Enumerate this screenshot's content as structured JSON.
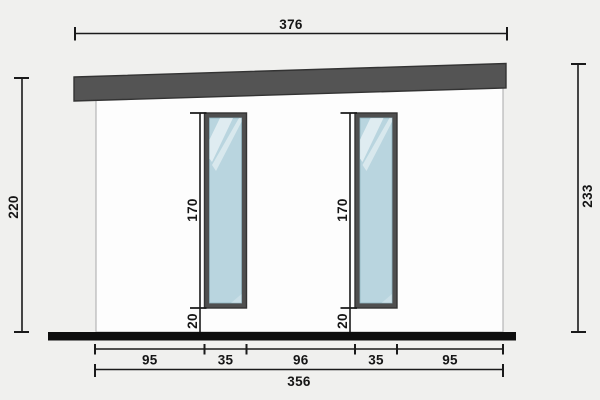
{
  "diagram": {
    "type": "building-elevation-drawing",
    "top_width": "376",
    "left_height": "220",
    "right_height": "233",
    "windows": {
      "left": {
        "height": "170",
        "bottom_offset": "20"
      },
      "right": {
        "height": "170",
        "bottom_offset": "20"
      }
    },
    "bottom_segments": [
      "95",
      "35",
      "96",
      "35",
      "95"
    ],
    "bottom_total": "356",
    "colors": {
      "background": "#f0f0ee",
      "wall": "#fdfdfd",
      "roof": "#545454",
      "window_frame": "#4f4f4f",
      "glass": "#b9d5df",
      "ground": "#0e0e0e",
      "dimension": "#1a1a1a"
    }
  }
}
